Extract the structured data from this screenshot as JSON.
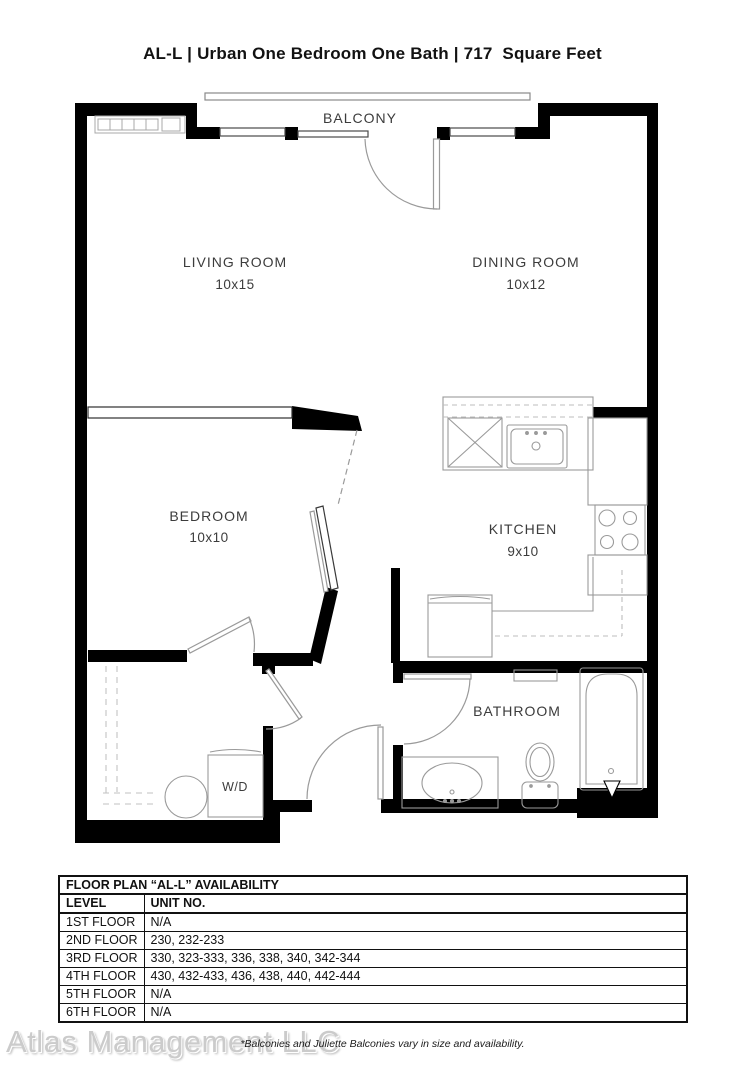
{
  "title": "AL-L | Urban One Bedroom One Bath | 717  Square Feet",
  "plan": {
    "rooms": [
      {
        "name": "BALCONY",
        "dims": ""
      },
      {
        "name": "LIVING ROOM",
        "dims": "10x15"
      },
      {
        "name": "DINING ROOM",
        "dims": "10x12"
      },
      {
        "name": "BEDROOM",
        "dims": "10x10"
      },
      {
        "name": "KITCHEN",
        "dims": "9x10"
      },
      {
        "name": "BATHROOM",
        "dims": ""
      },
      {
        "name": "W/D",
        "dims": ""
      }
    ],
    "colors": {
      "wall": "#000000",
      "fixture": "#9a9a9a",
      "label": "#3c3c3c"
    }
  },
  "availability_table": {
    "title": "FLOOR PLAN “AL-L” AVAILABILITY",
    "columns": [
      "LEVEL",
      "UNIT NO."
    ],
    "rows": [
      {
        "level": "1ST FLOOR",
        "units": "N/A"
      },
      {
        "level": "2ND FLOOR",
        "units": "230, 232-233"
      },
      {
        "level": "3RD FLOOR",
        "units": "330, 323-333, 336, 338, 340, 342-344"
      },
      {
        "level": "4TH FLOOR",
        "units": "430, 432-433, 436, 438, 440, 442-444"
      },
      {
        "level": "5TH FLOOR",
        "units": "N/A"
      },
      {
        "level": "6TH FLOOR",
        "units": "N/A"
      }
    ]
  },
  "footnote": "*Balconies and Juliette Balconies vary in size and availability.",
  "watermark": "Atlas Management LLC"
}
